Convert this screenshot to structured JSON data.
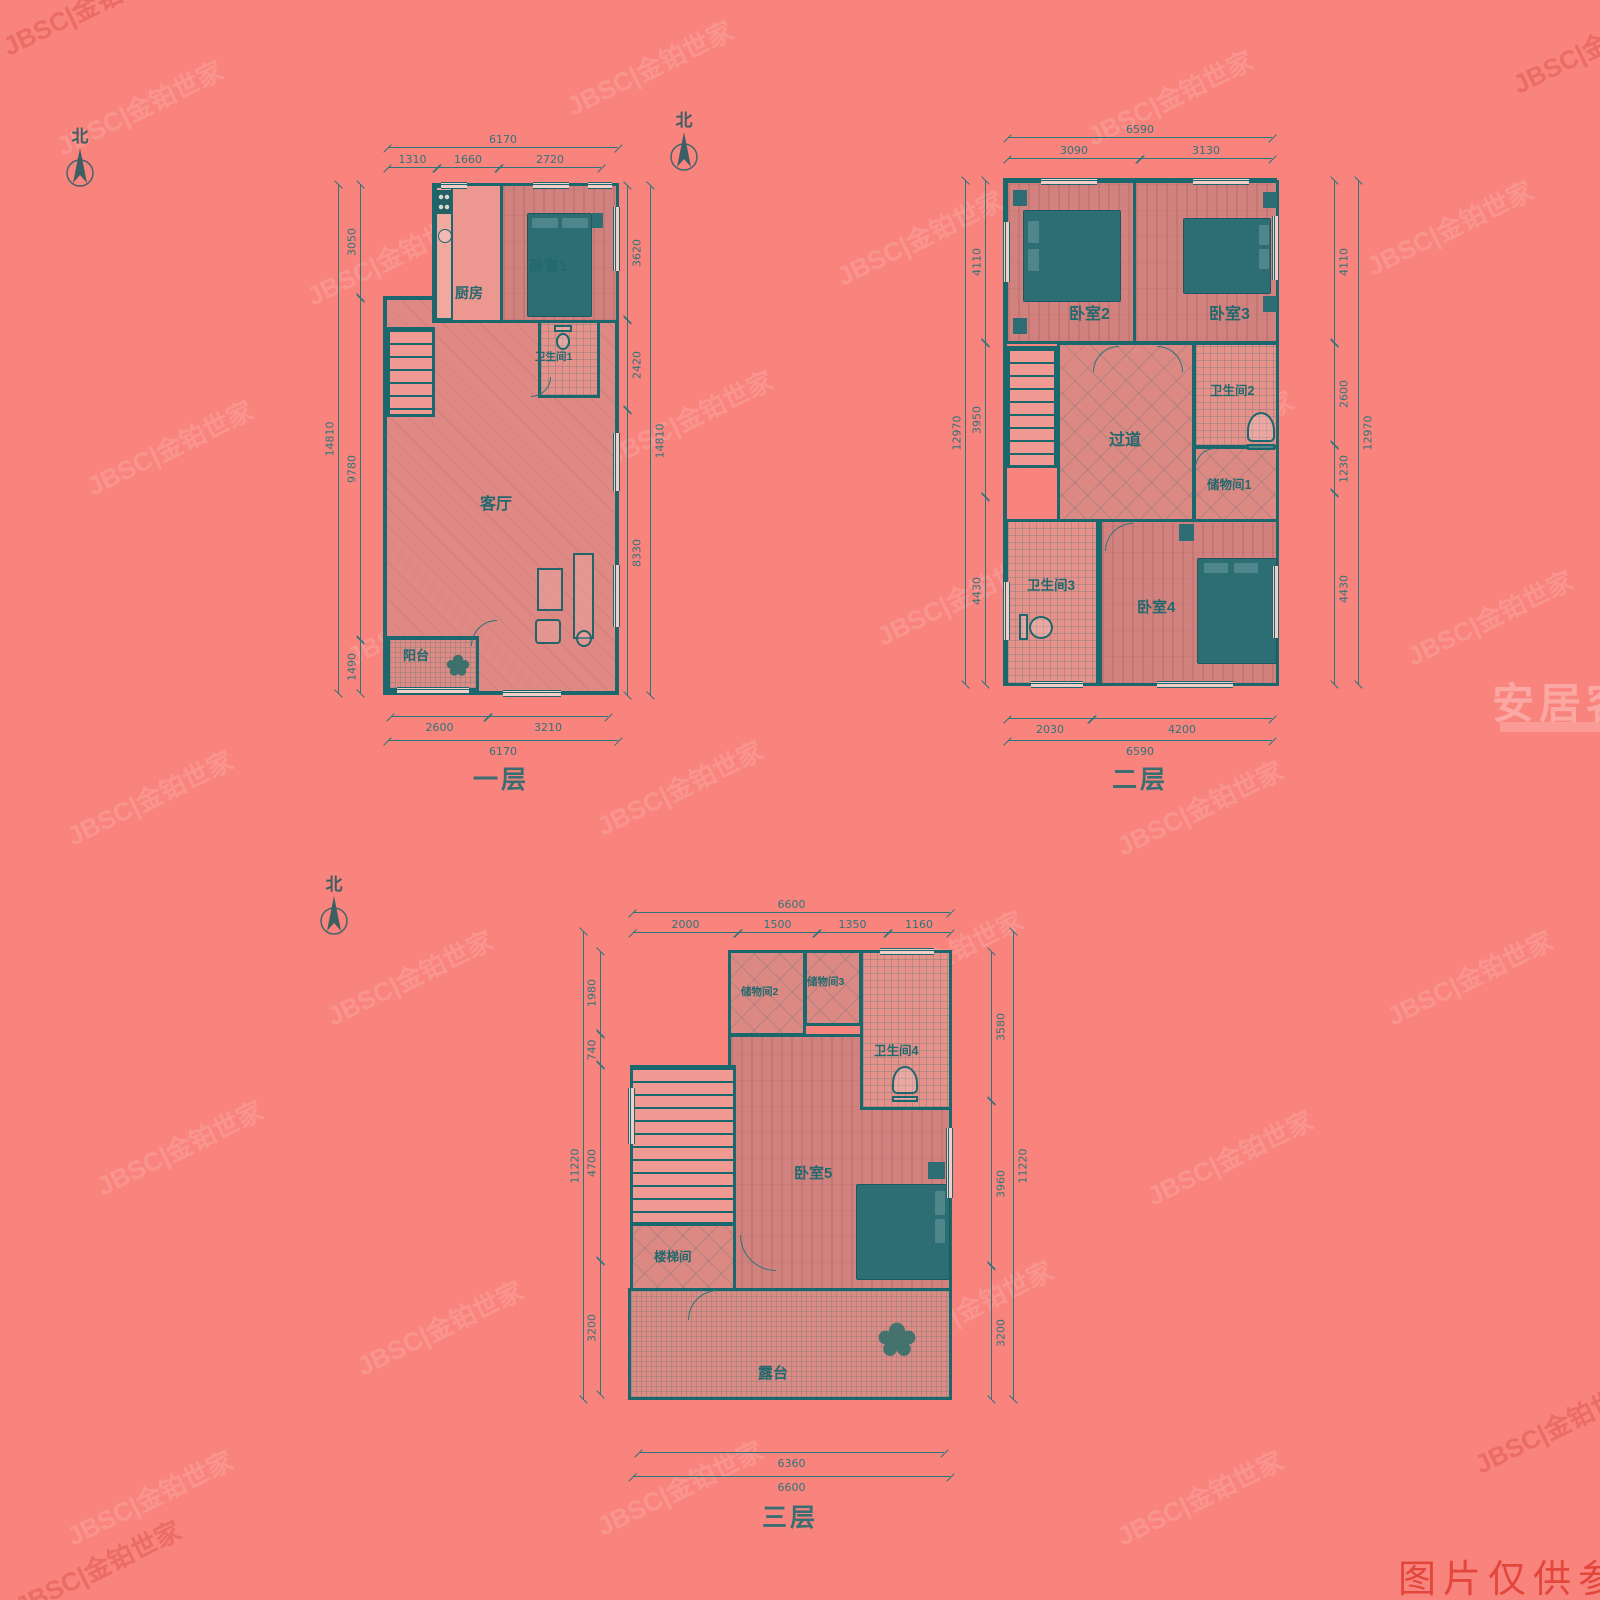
{
  "colors": {
    "background": "#f9837d",
    "wall_teal": "#1a686d",
    "dimension_text": "#2e7579",
    "room_text": "#21696e",
    "furniture_teal": "#2c6e74",
    "stamp_red": "#e04034"
  },
  "watermarks": {
    "brand": "JBSC|金铂世家",
    "site": "安居客",
    "disclaimer": "图片仅供参考"
  },
  "north_label": "北",
  "floors": [
    {
      "label": "一层",
      "rooms": {
        "kitchen": "厨房",
        "bedroom1": "卧室1",
        "bath1": "卫生间1",
        "living": "客厅",
        "balcony": "阳台"
      },
      "dims": {
        "top_total": "6170",
        "top_segments": [
          "1310",
          "1660",
          "2720"
        ],
        "left_total": "14810",
        "left_segments": [
          "3050",
          "9780",
          "1490"
        ],
        "right_total": "14810",
        "right_segments": [
          "3620",
          "2420",
          "8330"
        ],
        "bottom_segments": [
          "2600",
          "3210"
        ],
        "bottom_total": "6170"
      }
    },
    {
      "label": "二层",
      "rooms": {
        "bedroom2": "卧室2",
        "bedroom3": "卧室3",
        "hallway": "过道",
        "bath2": "卫生间2",
        "storage1": "储物间1",
        "bath3": "卫生间3",
        "bedroom4": "卧室4"
      },
      "dims": {
        "top_total": "6590",
        "top_segments": [
          "3090",
          "3130"
        ],
        "left_total": "12970",
        "left_segments": [
          "4110",
          "3950",
          "4430"
        ],
        "right_total": "12970",
        "right_segments": [
          "4110",
          "2600",
          "1230",
          "4430"
        ],
        "bottom_segments": [
          "2030",
          "4200"
        ],
        "bottom_total": "6590"
      }
    },
    {
      "label": "三层",
      "rooms": {
        "storage2": "储物间2",
        "storage3": "储物间3",
        "bath4": "卫生间4",
        "bedroom5": "卧室5",
        "stair_room": "楼梯间",
        "terrace": "露台"
      },
      "dims": {
        "top_total": "6600",
        "top_segments": [
          "2000",
          "1500",
          "1350",
          "1160"
        ],
        "left_total": "11220",
        "left_segments": [
          "1980",
          "740",
          "4700",
          "3200"
        ],
        "right_total": "11220",
        "right_segments": [
          "3580",
          "3960",
          "3200"
        ],
        "bottom_inner": "6360",
        "bottom_total": "6600"
      }
    }
  ]
}
